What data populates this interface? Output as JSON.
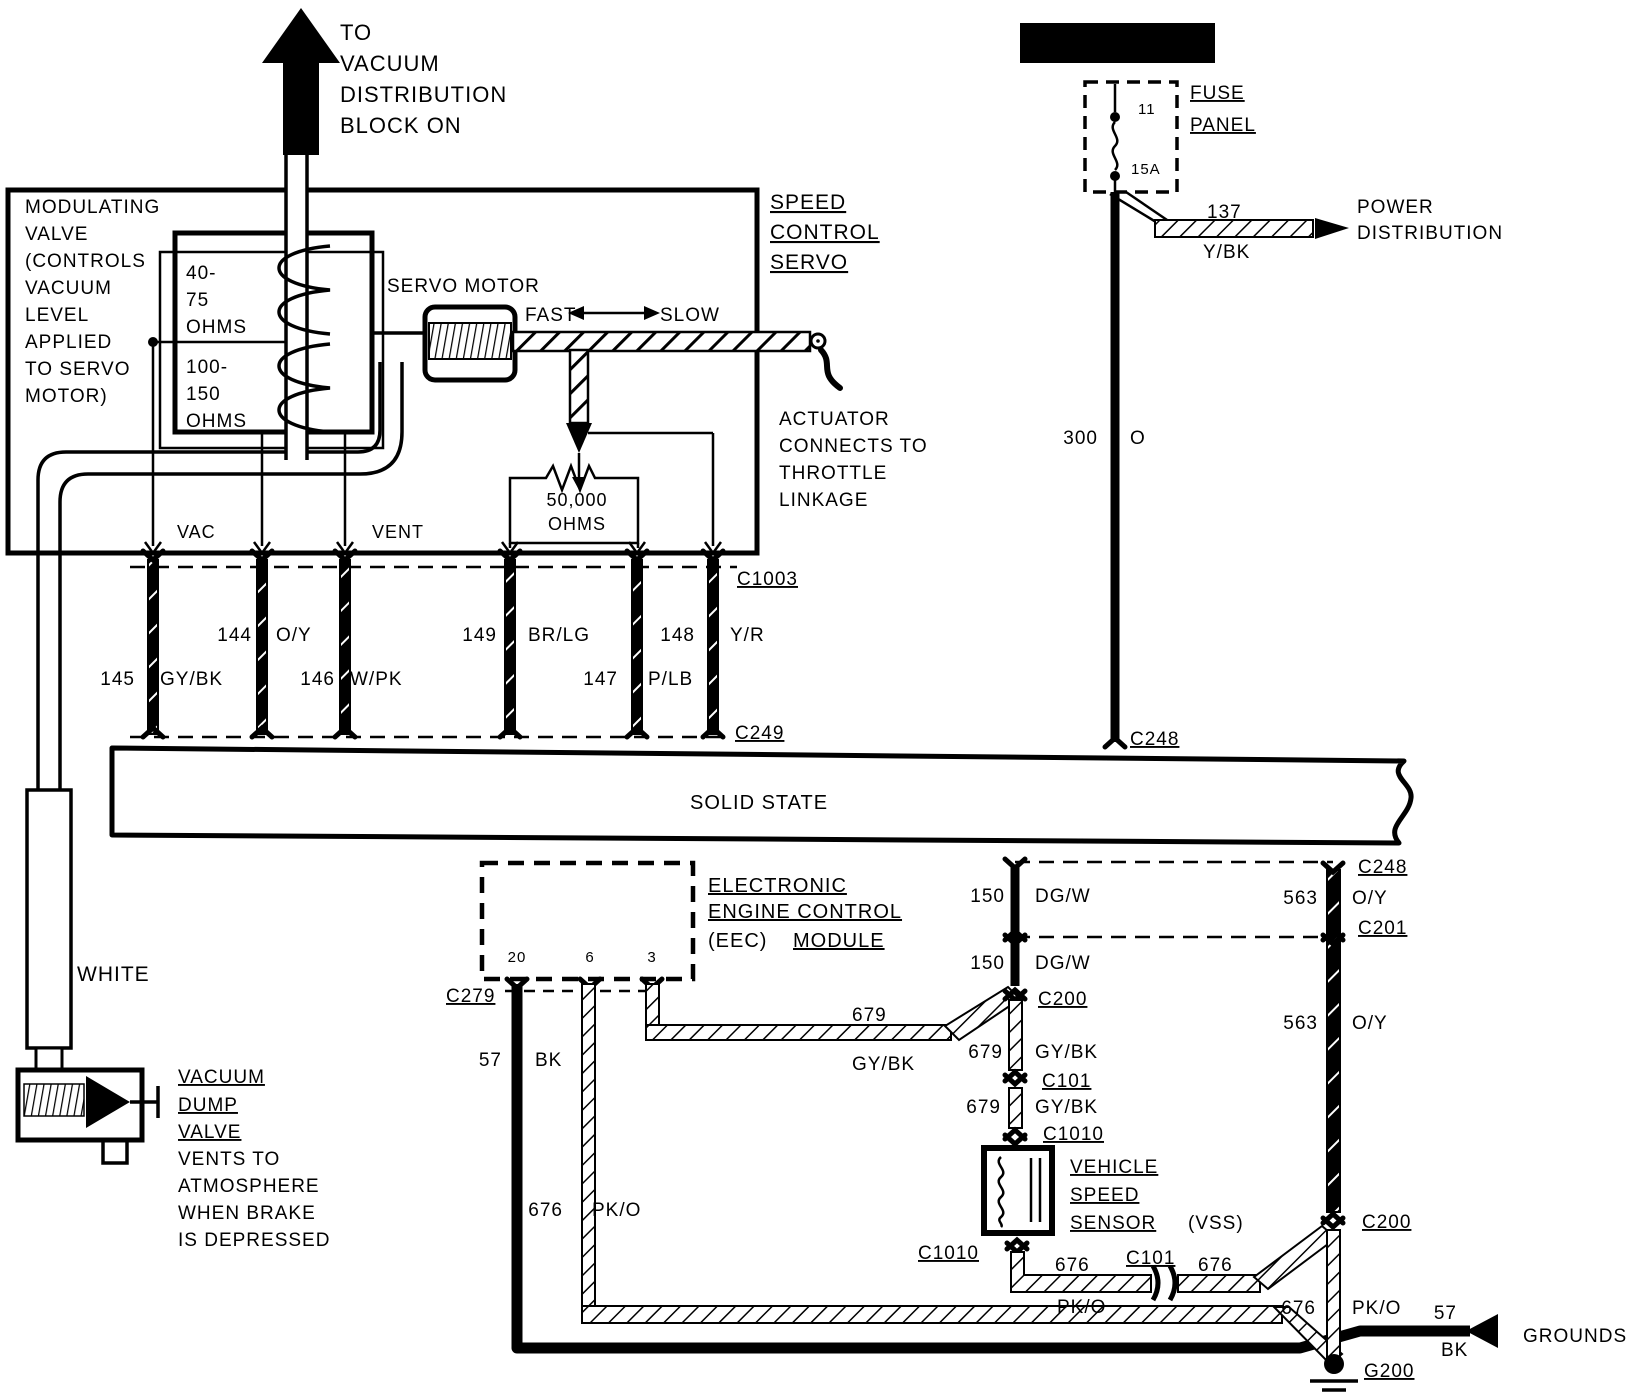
{
  "colors": {
    "ink": "#000000",
    "paper": "#ffffff"
  },
  "diagram": {
    "subject": "speed-control-servo-wiring",
    "components": [
      "SPEED CONTROL SERVO",
      "MODULATING VALVE",
      "SERVO MOTOR",
      "FUSE PANEL",
      "SOLID STATE",
      "ELECTRONIC ENGINE CONTROL (EEC) MODULE",
      "VEHICLE SPEED SENSOR (VSS)",
      "VACUUM DUMP VALVE"
    ],
    "connectors": [
      "C1003",
      "C249",
      "C248",
      "C201",
      "C200",
      "C101",
      "C1010",
      "C279",
      "G200"
    ],
    "circuits": [
      {
        "num": "137",
        "color": "Y/BK"
      },
      {
        "num": "300",
        "color": "O"
      },
      {
        "num": "144",
        "color": "O/Y"
      },
      {
        "num": "145",
        "color": "GY/BK"
      },
      {
        "num": "146",
        "color": "W/PK"
      },
      {
        "num": "147",
        "color": "P/LB"
      },
      {
        "num": "148",
        "color": "Y/R"
      },
      {
        "num": "149",
        "color": "BR/LG"
      },
      {
        "num": "150",
        "color": "DG/W"
      },
      {
        "num": "563",
        "color": "O/Y"
      },
      {
        "num": "679",
        "color": "GY/BK"
      },
      {
        "num": "676",
        "color": "PK/O"
      },
      {
        "num": "57",
        "color": "BK"
      }
    ]
  },
  "labels": [
    {
      "name": "to-vacuum-note",
      "lines": [
        "TO",
        "VACUUM",
        "DISTRIBUTION",
        "BLOCK ON"
      ],
      "x": 340,
      "y": 40,
      "size": 22,
      "lh": 31
    },
    {
      "name": "z-marker",
      "text": "Z",
      "x": 299,
      "y": 50,
      "size": 26,
      "anchor": "middle",
      "fill": "#ffffff",
      "bold": true
    },
    {
      "name": "modulating-valve-note",
      "lines": [
        "MODULATING",
        "VALVE",
        "(CONTROLS",
        "VACUUM",
        "LEVEL",
        "APPLIED",
        "TO SERVO",
        "MOTOR)"
      ],
      "x": 25,
      "y": 213,
      "size": 19,
      "lh": 27
    },
    {
      "name": "coil1-ohms",
      "lines": [
        "40-",
        "75",
        "OHMS"
      ],
      "x": 186,
      "y": 279,
      "size": 19,
      "lh": 27
    },
    {
      "name": "coil2-ohms",
      "lines": [
        "100-",
        "150",
        "OHMS"
      ],
      "x": 186,
      "y": 373,
      "size": 19,
      "lh": 27
    },
    {
      "name": "servo-motor-label",
      "text": "SERVO MOTOR",
      "x": 387,
      "y": 292,
      "size": 19
    },
    {
      "name": "fast-label",
      "text": "FAST",
      "x": 525,
      "y": 321,
      "size": 19
    },
    {
      "name": "slow-label",
      "text": "SLOW",
      "x": 660,
      "y": 321,
      "size": 19
    },
    {
      "name": "speed-control-servo-label",
      "lines": [
        "SPEED",
        "CONTROL",
        "SERVO"
      ],
      "x": 770,
      "y": 209,
      "size": 21,
      "lh": 30,
      "underline": true
    },
    {
      "name": "actuator-note",
      "lines": [
        "ACTUATOR",
        "CONNECTS TO",
        "THROTTLE",
        "LINKAGE"
      ],
      "x": 779,
      "y": 425,
      "size": 19,
      "lh": 27
    },
    {
      "name": "resistor-value",
      "lines": [
        "50,000",
        "OHMS"
      ],
      "x": 577,
      "y": 506,
      "size": 18,
      "lh": 24,
      "anchor": "middle"
    },
    {
      "name": "vac-label",
      "text": "VAC",
      "x": 177,
      "y": 538,
      "size": 18
    },
    {
      "name": "vent-label",
      "text": "VENT",
      "x": 372,
      "y": 538,
      "size": 18
    },
    {
      "name": "c1003-label",
      "text": "C1003",
      "x": 737,
      "y": 585,
      "size": 19,
      "underline": true
    },
    {
      "name": "c249-label",
      "text": "C249",
      "x": 735,
      "y": 739,
      "size": 19,
      "underline": true
    },
    {
      "name": "wire-144",
      "text": "144",
      "x": 252,
      "y": 641,
      "size": 19,
      "anchor": "end"
    },
    {
      "name": "wire-144-color",
      "text": "O/Y",
      "x": 276,
      "y": 641,
      "size": 19
    },
    {
      "name": "wire-149",
      "text": "149",
      "x": 497,
      "y": 641,
      "size": 19,
      "anchor": "end"
    },
    {
      "name": "wire-149-color",
      "text": "BR/LG",
      "x": 528,
      "y": 641,
      "size": 19
    },
    {
      "name": "wire-148",
      "text": "148",
      "x": 695,
      "y": 641,
      "size": 19,
      "anchor": "end"
    },
    {
      "name": "wire-148-color",
      "text": "Y/R",
      "x": 730,
      "y": 641,
      "size": 19
    },
    {
      "name": "wire-145",
      "text": "145",
      "x": 135,
      "y": 685,
      "size": 19,
      "anchor": "end"
    },
    {
      "name": "wire-145-color",
      "text": "GY/BK",
      "x": 160,
      "y": 685,
      "size": 19
    },
    {
      "name": "wire-146",
      "text": "146",
      "x": 335,
      "y": 685,
      "size": 19,
      "anchor": "end"
    },
    {
      "name": "wire-146-color",
      "text": "W/PK",
      "x": 350,
      "y": 685,
      "size": 19
    },
    {
      "name": "wire-147",
      "text": "147",
      "x": 618,
      "y": 685,
      "size": 19,
      "anchor": "end"
    },
    {
      "name": "wire-147-color",
      "text": "P/LB",
      "x": 648,
      "y": 685,
      "size": 19
    },
    {
      "name": "solid-state-label",
      "text": "SOLID STATE",
      "x": 690,
      "y": 809,
      "size": 20
    },
    {
      "name": "hot-in-acc-banner",
      "text": "HOT IN ACC OR RUN",
      "x": 1117,
      "y": 50,
      "size": 15,
      "anchor": "middle",
      "fill": "#ffffff",
      "bold": true
    },
    {
      "name": "fuse-label",
      "text": "FUSE",
      "x": 1190,
      "y": 99,
      "size": 19,
      "underline": true
    },
    {
      "name": "panel-label",
      "text": "PANEL",
      "x": 1190,
      "y": 131,
      "size": 19,
      "underline": true
    },
    {
      "name": "fuse-cavity",
      "text": "11",
      "x": 1138,
      "y": 114,
      "size": 15
    },
    {
      "name": "fuse-rating",
      "text": "15A",
      "x": 1131,
      "y": 174,
      "size": 15
    },
    {
      "name": "wire-137",
      "text": "137",
      "x": 1207,
      "y": 218,
      "size": 19
    },
    {
      "name": "wire-137-color",
      "text": "Y/BK",
      "x": 1203,
      "y": 258,
      "size": 19
    },
    {
      "name": "power-distribution-label",
      "lines": [
        "POWER",
        "DISTRIBUTION"
      ],
      "x": 1357,
      "y": 213,
      "size": 19,
      "lh": 26
    },
    {
      "name": "wire-300",
      "text": "300",
      "x": 1098,
      "y": 444,
      "size": 19,
      "anchor": "end"
    },
    {
      "name": "wire-300-color",
      "text": "O",
      "x": 1130,
      "y": 444,
      "size": 19
    },
    {
      "name": "c248-top-label",
      "text": "C248",
      "x": 1130,
      "y": 745,
      "size": 19,
      "underline": true
    },
    {
      "name": "c248-mid-label",
      "text": "C248",
      "x": 1358,
      "y": 873,
      "size": 19,
      "underline": true
    },
    {
      "name": "wire-563-color-1",
      "text": "O/Y",
      "x": 1352,
      "y": 904,
      "size": 19
    },
    {
      "name": "c201-label",
      "text": "C201",
      "x": 1358,
      "y": 934,
      "size": 19,
      "underline": true
    },
    {
      "name": "wire-150-1",
      "text": "150",
      "x": 1005,
      "y": 902,
      "size": 19,
      "anchor": "end"
    },
    {
      "name": "wire-150-color-1",
      "text": "DG/W",
      "x": 1035,
      "y": 902,
      "size": 19
    },
    {
      "name": "wire-150-2",
      "text": "150",
      "x": 1005,
      "y": 969,
      "size": 19,
      "anchor": "end"
    },
    {
      "name": "wire-150-color-2",
      "text": "DG/W",
      "x": 1035,
      "y": 969,
      "size": 19
    },
    {
      "name": "wire-563-1",
      "text": "563",
      "x": 1318,
      "y": 904,
      "size": 19,
      "anchor": "end"
    },
    {
      "name": "wire-563-2",
      "text": "563",
      "x": 1318,
      "y": 1029,
      "size": 19,
      "anchor": "end"
    },
    {
      "name": "wire-563-color-2",
      "text": "O/Y",
      "x": 1352,
      "y": 1029,
      "size": 19
    },
    {
      "name": "c200-1-label",
      "text": "C200",
      "x": 1038,
      "y": 1005,
      "size": 19,
      "underline": true
    },
    {
      "name": "wire-679-1",
      "text": "679",
      "x": 1003,
      "y": 1058,
      "size": 19,
      "anchor": "end"
    },
    {
      "name": "wire-679-color-1",
      "text": "GY/BK",
      "x": 1035,
      "y": 1058,
      "size": 19
    },
    {
      "name": "c101-1-label",
      "text": "C101",
      "x": 1042,
      "y": 1087,
      "size": 19,
      "underline": true
    },
    {
      "name": "wire-679-2",
      "text": "679",
      "x": 1001,
      "y": 1113,
      "size": 19,
      "anchor": "end"
    },
    {
      "name": "wire-679-color-2",
      "text": "GY/BK",
      "x": 1035,
      "y": 1113,
      "size": 19
    },
    {
      "name": "c1010-1-label",
      "text": "C1010",
      "x": 1043,
      "y": 1140,
      "size": 19,
      "underline": true
    },
    {
      "name": "vss-label-1",
      "text": "VEHICLE",
      "x": 1070,
      "y": 1173,
      "size": 19,
      "underline": true
    },
    {
      "name": "vss-label-2",
      "text": "SPEED",
      "x": 1070,
      "y": 1201,
      "size": 19,
      "underline": true
    },
    {
      "name": "vss-label-3",
      "text": "SENSOR",
      "x": 1070,
      "y": 1229,
      "size": 19,
      "underline": true
    },
    {
      "name": "vss-label-4",
      "text": "(VSS)",
      "x": 1188,
      "y": 1229,
      "size": 19
    },
    {
      "name": "c1010-2-label",
      "text": "C1010",
      "x": 918,
      "y": 1259,
      "size": 19,
      "underline": true
    },
    {
      "name": "wire-676-a",
      "text": "676",
      "x": 1055,
      "y": 1271,
      "size": 19
    },
    {
      "name": "wire-676-color-a",
      "text": "PK/O",
      "x": 1057,
      "y": 1313,
      "size": 19
    },
    {
      "name": "c101-2-label",
      "text": "C101",
      "x": 1126,
      "y": 1264,
      "size": 19,
      "underline": true
    },
    {
      "name": "wire-676-b",
      "text": "676",
      "x": 1198,
      "y": 1271,
      "size": 19
    },
    {
      "name": "c200-2-label",
      "text": "C200",
      "x": 1362,
      "y": 1228,
      "size": 19,
      "underline": true
    },
    {
      "name": "wire-676-c",
      "text": "676",
      "x": 1316,
      "y": 1314,
      "size": 19,
      "anchor": "end"
    },
    {
      "name": "wire-676-color-c",
      "text": "PK/O",
      "x": 1352,
      "y": 1314,
      "size": 19
    },
    {
      "name": "g200-label",
      "text": "G200",
      "x": 1364,
      "y": 1377,
      "size": 19,
      "underline": true
    },
    {
      "name": "wire-57-b",
      "text": "57",
      "x": 1457,
      "y": 1319,
      "size": 19,
      "anchor": "end"
    },
    {
      "name": "wire-57-color-b",
      "text": "BK",
      "x": 1441,
      "y": 1356,
      "size": 19
    },
    {
      "name": "grounds-label",
      "text": "GROUNDS",
      "x": 1523,
      "y": 1342,
      "size": 19
    },
    {
      "name": "eec-label-1",
      "text": "ELECTRONIC",
      "x": 708,
      "y": 892,
      "size": 20,
      "underline": true
    },
    {
      "name": "eec-label-2",
      "text": "ENGINE CONTROL",
      "x": 708,
      "y": 918,
      "size": 20,
      "underline": true
    },
    {
      "name": "eec-label-3",
      "text": "(EEC)",
      "x": 708,
      "y": 947,
      "size": 20
    },
    {
      "name": "eec-label-4",
      "text": "MODULE",
      "x": 793,
      "y": 947,
      "size": 20,
      "underline": true
    },
    {
      "name": "eec-pin-20",
      "text": "20",
      "x": 517,
      "y": 962,
      "size": 15,
      "anchor": "middle"
    },
    {
      "name": "eec-pin-6",
      "text": "6",
      "x": 590,
      "y": 962,
      "size": 15,
      "anchor": "middle"
    },
    {
      "name": "eec-pin-3",
      "text": "3",
      "x": 652,
      "y": 962,
      "size": 15,
      "anchor": "middle"
    },
    {
      "name": "c279-label",
      "text": "C279",
      "x": 446,
      "y": 1002,
      "size": 19,
      "underline": true
    },
    {
      "name": "wire-57-a",
      "text": "57",
      "x": 502,
      "y": 1066,
      "size": 19,
      "anchor": "end"
    },
    {
      "name": "wire-57-color-a",
      "text": "BK",
      "x": 535,
      "y": 1066,
      "size": 19
    },
    {
      "name": "wire-676-d",
      "text": "676",
      "x": 563,
      "y": 1216,
      "size": 19,
      "anchor": "end"
    },
    {
      "name": "wire-676-color-d",
      "text": "PK/O",
      "x": 592,
      "y": 1216,
      "size": 19
    },
    {
      "name": "wire-679-h",
      "text": "679",
      "x": 852,
      "y": 1021,
      "size": 19
    },
    {
      "name": "wire-679-color-h",
      "text": "GY/BK",
      "x": 852,
      "y": 1070,
      "size": 19
    },
    {
      "name": "white-label",
      "text": "WHITE",
      "x": 77,
      "y": 981,
      "size": 21
    },
    {
      "name": "vacuum-dump-1",
      "text": "VACUUM",
      "x": 178,
      "y": 1083,
      "size": 19,
      "underline": true
    },
    {
      "name": "vacuum-dump-2",
      "text": "DUMP",
      "x": 178,
      "y": 1111,
      "size": 19,
      "underline": true
    },
    {
      "name": "vacuum-dump-3",
      "text": "VALVE",
      "x": 178,
      "y": 1138,
      "size": 19,
      "underline": true
    },
    {
      "name": "vacuum-dump-note",
      "lines": [
        "VENTS TO",
        "ATMOSPHERE",
        "WHEN BRAKE",
        "IS DEPRESSED"
      ],
      "x": 178,
      "y": 1165,
      "size": 19,
      "lh": 27
    }
  ]
}
